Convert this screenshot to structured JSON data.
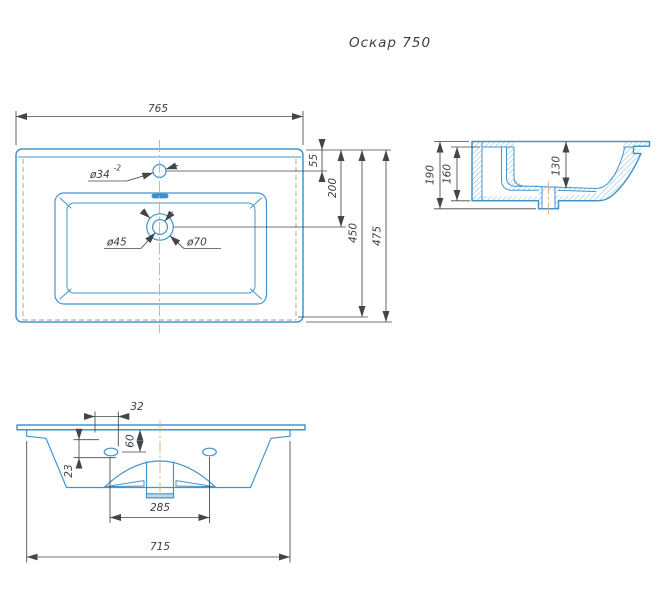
{
  "title": "Оскар 750",
  "colors": {
    "outline_blue": "#4295cc",
    "dimension_gray": "#42464b",
    "centerline_tan": "#d9ad6e",
    "hidden_gray": "#9aa8b0",
    "background": "#ffffff"
  },
  "top_view": {
    "dim_overall_width": "765",
    "dim_faucet_offset": "55",
    "dim_drain_offset": "200",
    "dim_inner_depth": "450",
    "dim_overall_depth": "475",
    "faucet_hole_dia": "ø34",
    "faucet_hole_tolerance": "-2",
    "drain_hole_dia": "ø45",
    "drain_recess_dia": "ø70"
  },
  "side_view": {
    "dim_overall_height": "190",
    "dim_body_height": "160",
    "dim_bowl_depth": "130"
  },
  "front_view": {
    "dim_hole_inset": "32",
    "dim_hole_drop": "60",
    "dim_flange_height": "23",
    "dim_holes_spacing": "285",
    "dim_bottom_width": "715"
  }
}
